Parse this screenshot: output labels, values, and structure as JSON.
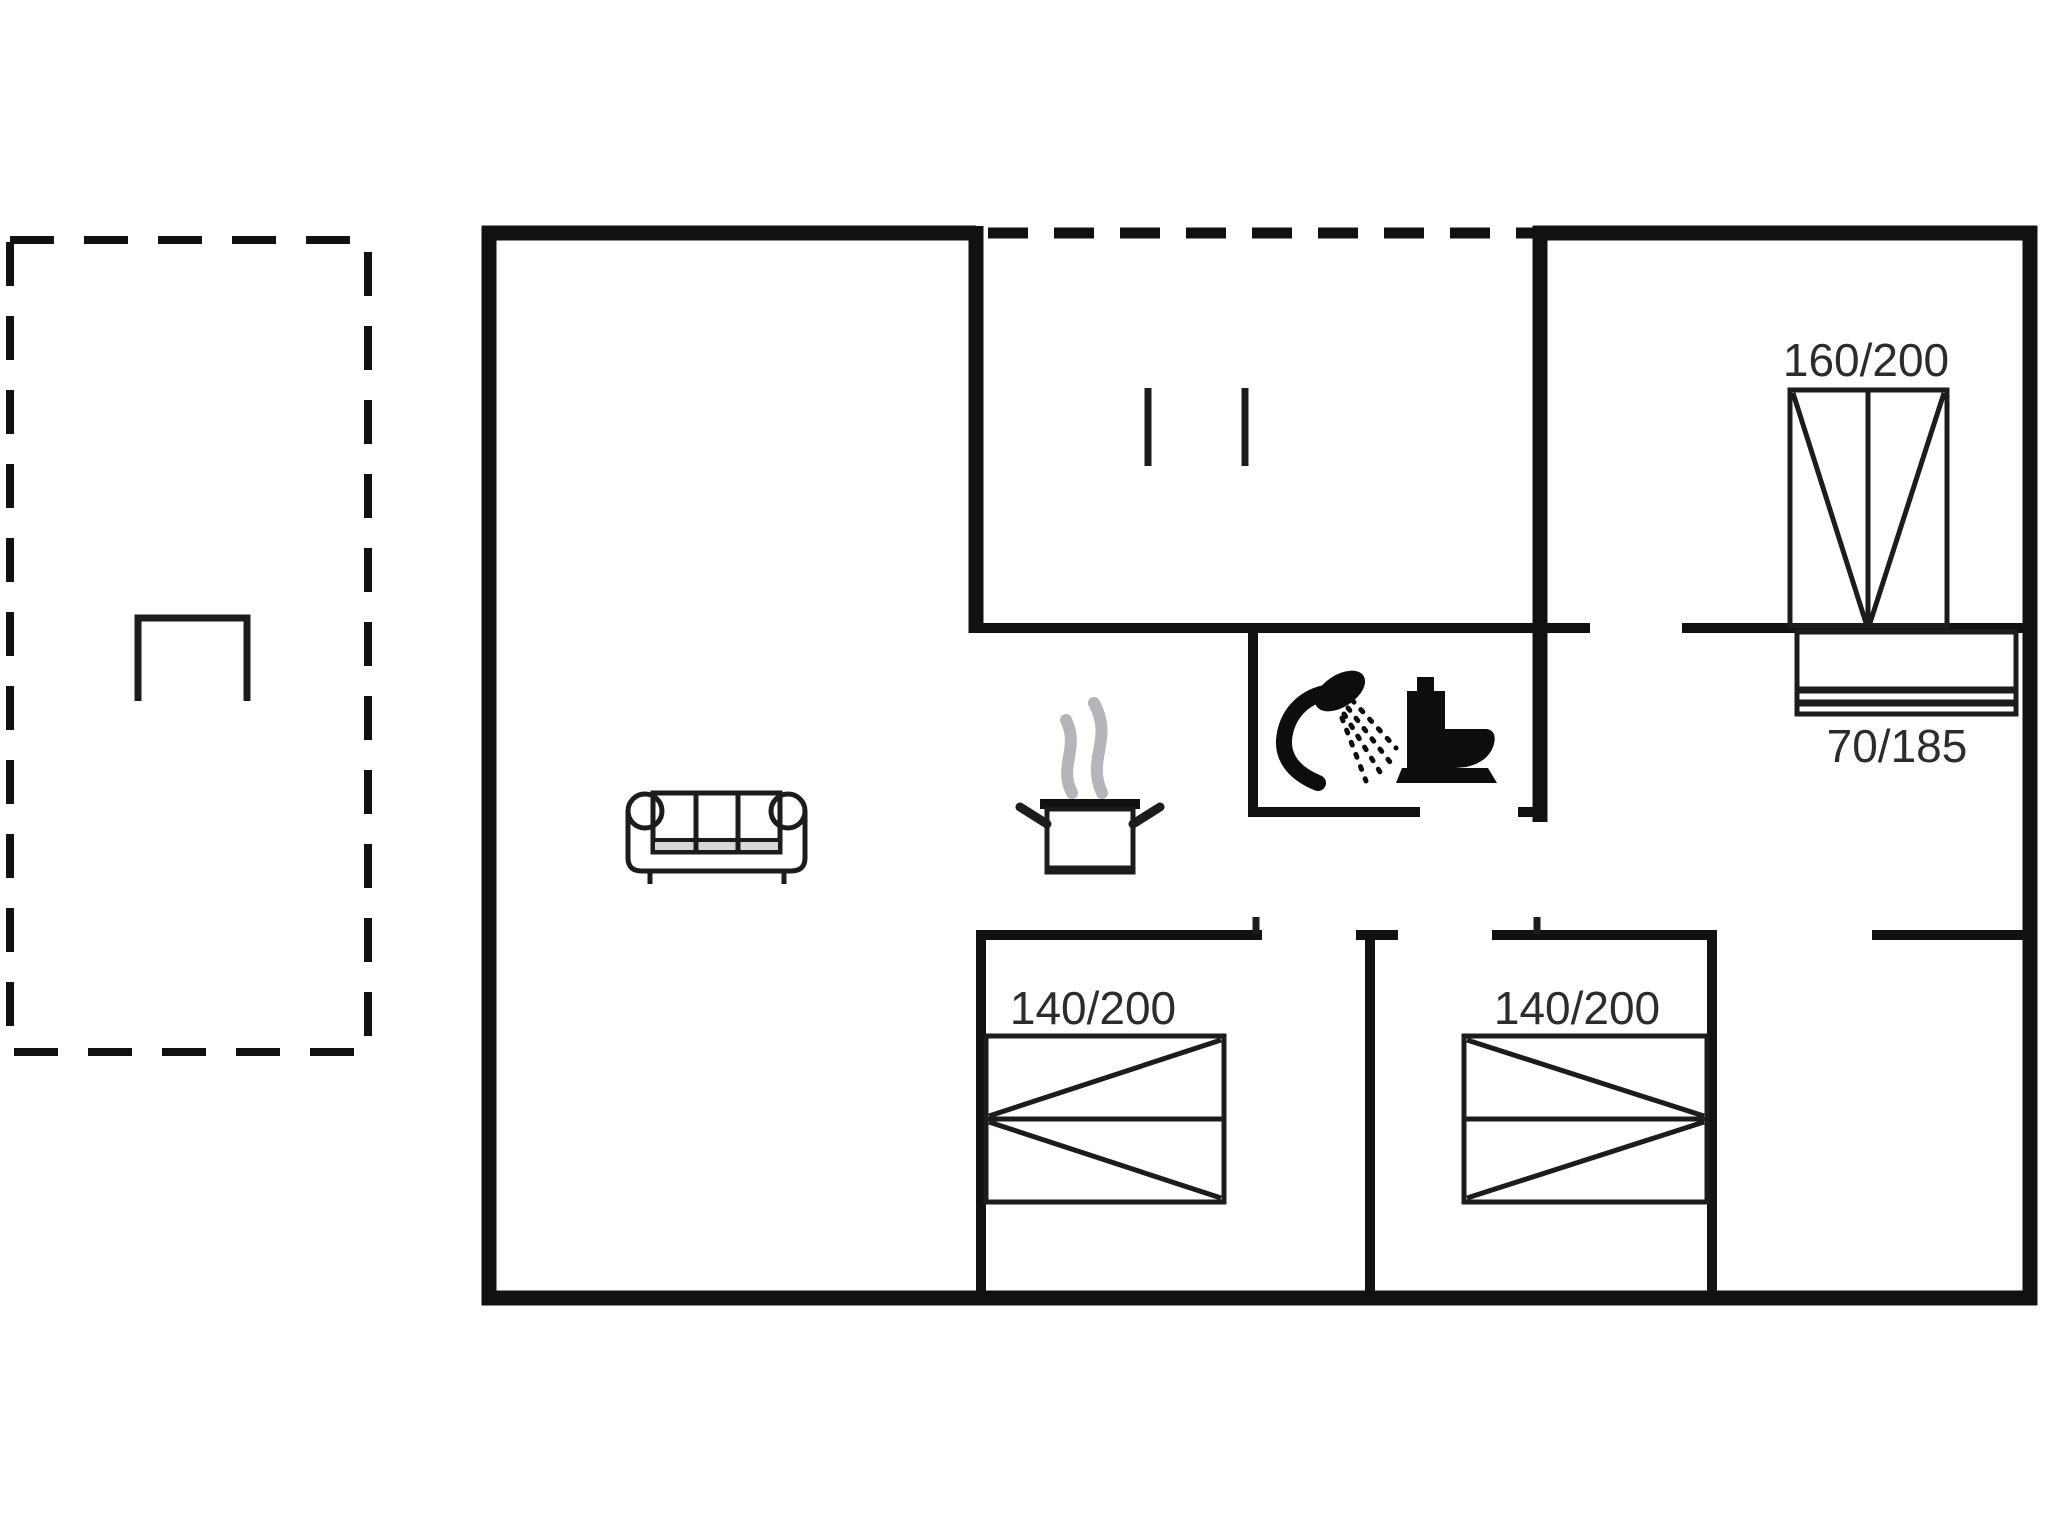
{
  "floorplan": {
    "labels": {
      "bed_top_right": "160/200",
      "sideboard_top_right": "70/185",
      "bed_bottom_left": "140/200",
      "bed_bottom_right": "140/200"
    },
    "colors": {
      "wall": "#111111",
      "furniture": "#1c1c1c",
      "icon": "#0d0d0d",
      "steam": "#b4b4b9",
      "text": "#2c2c2c",
      "background": "#ffffff"
    },
    "icons": [
      "sofa-icon",
      "cooking-pot-icon",
      "steam-icon",
      "shower-icon",
      "toilet-icon",
      "terrace-table-icon"
    ]
  }
}
